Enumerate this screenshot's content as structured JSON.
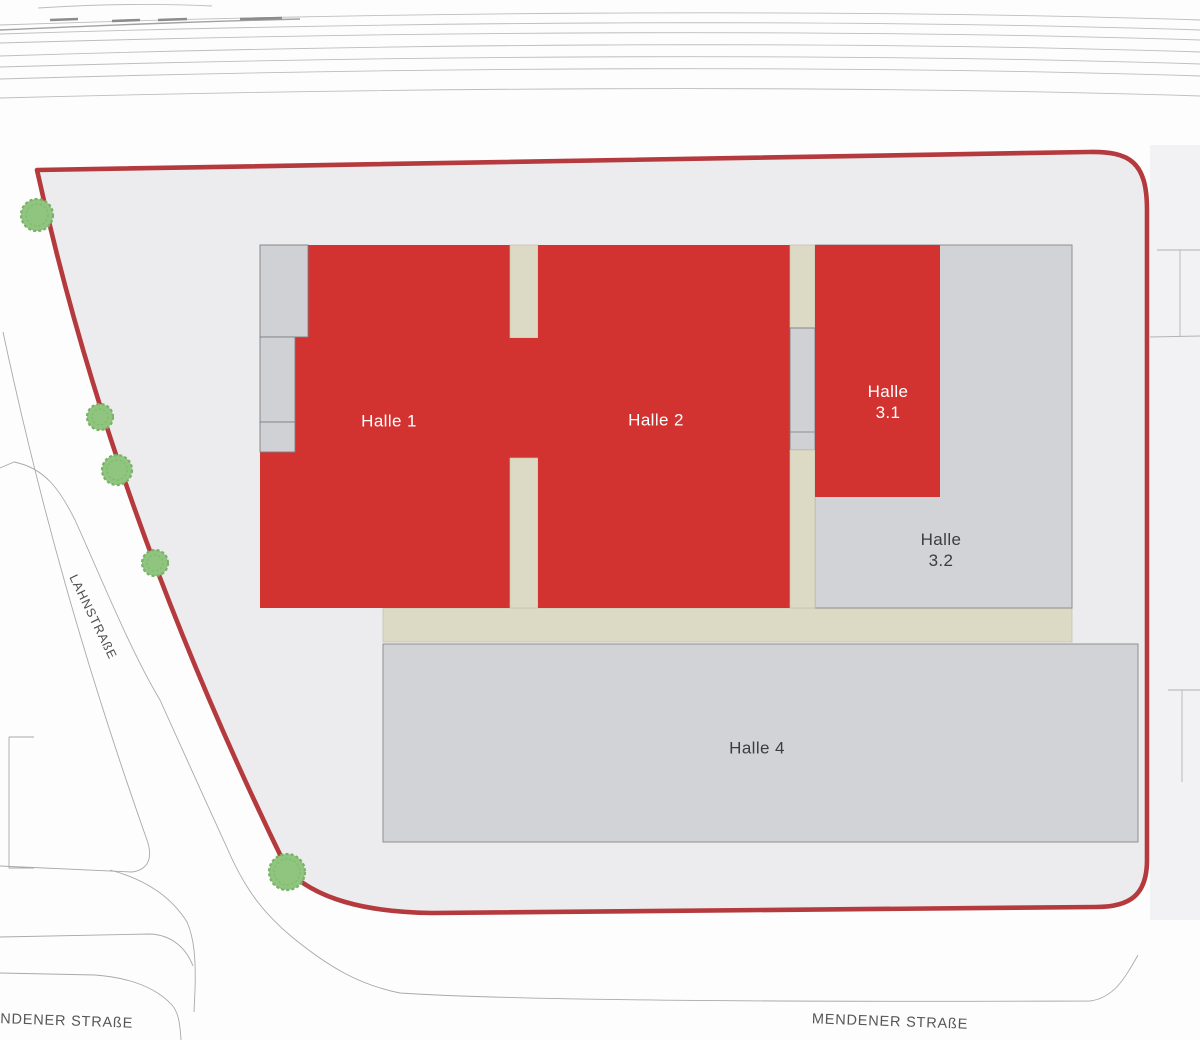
{
  "plan": {
    "title": "Site plan with halls",
    "halls": {
      "halle1": {
        "label": "Halle 1"
      },
      "halle2": {
        "label": "Halle 2"
      },
      "halle31": {
        "label": "Halle\n3.1"
      },
      "halle32": {
        "label": "Halle\n3.2"
      },
      "halle4": {
        "label": "Halle 4"
      }
    },
    "streets": {
      "lahnstrasse": {
        "label": "LAHNSTRAßE"
      },
      "mendener_left": {
        "label": "MENDENER STRAßE"
      },
      "mendener_right": {
        "label": "MENDENER STRAßE"
      }
    },
    "colors": {
      "highlight_red": "#d23230",
      "boundary_red": "#b43a3e",
      "building_gray": "#d2d3d6",
      "apron_beige": "#dcd9c4",
      "site_fill": "#ececee",
      "tree_green": "#8fc57e",
      "tree_green_dark": "#7ab168"
    },
    "trees": [
      {
        "x": 37,
        "y": 215,
        "r": 16
      },
      {
        "x": 100,
        "y": 417,
        "r": 13
      },
      {
        "x": 117,
        "y": 470,
        "r": 15
      },
      {
        "x": 155,
        "y": 563,
        "r": 13
      },
      {
        "x": 287,
        "y": 872,
        "r": 18
      }
    ]
  }
}
